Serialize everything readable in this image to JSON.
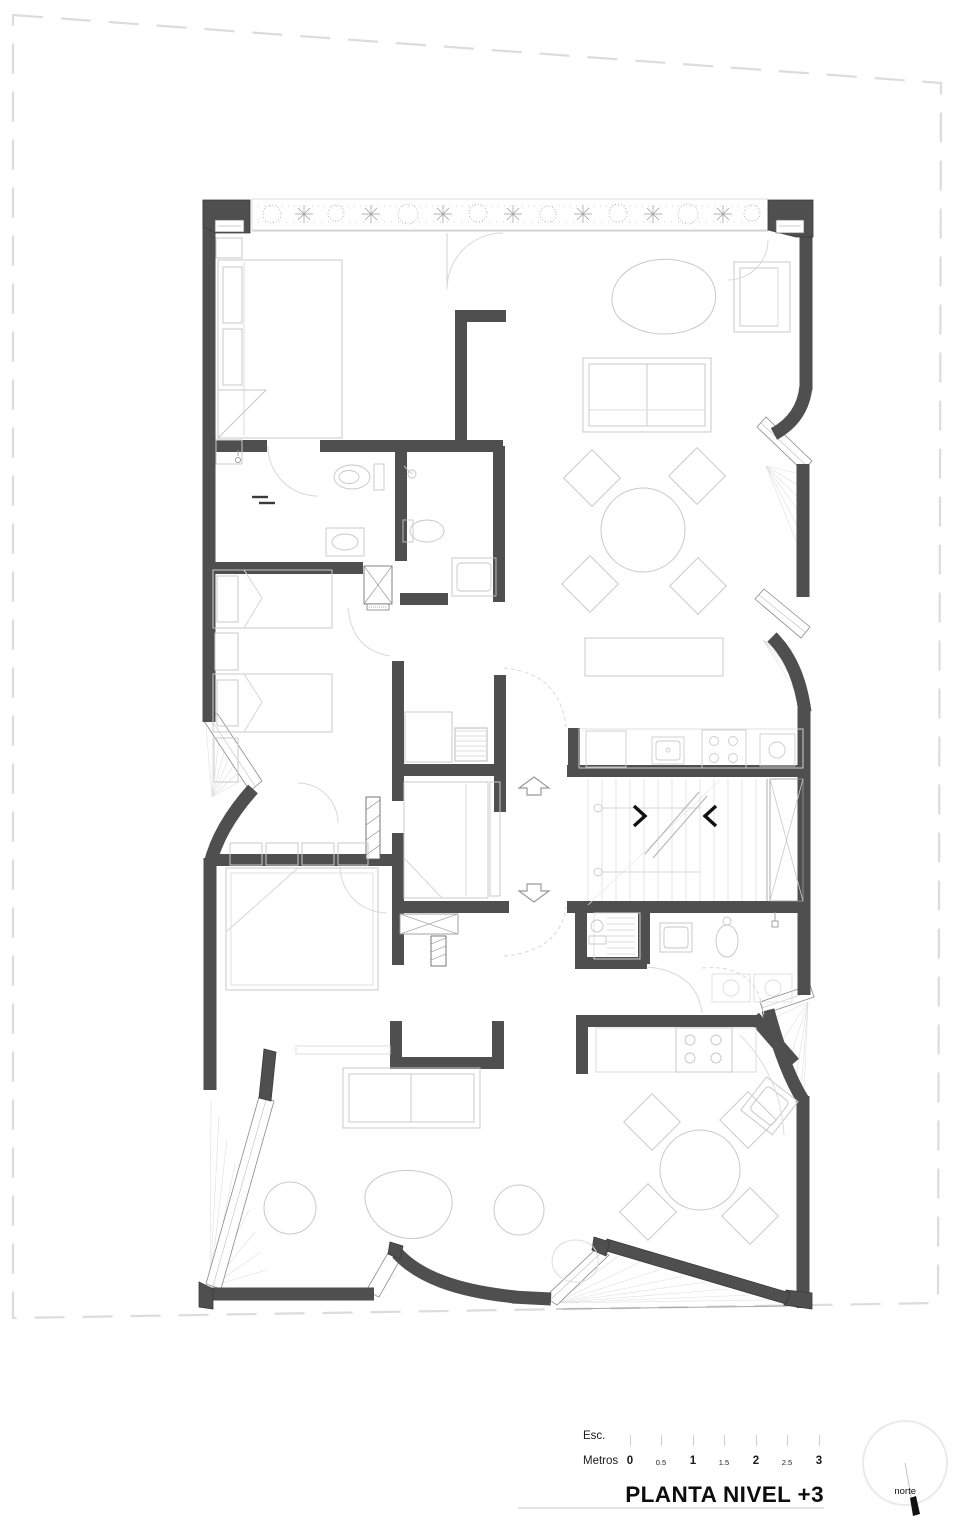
{
  "title_block": {
    "scale_label": "Esc.",
    "units_label": "Metros",
    "ticks": [
      "0",
      "0.5",
      "1",
      "1.5",
      "2",
      "2.5",
      "3"
    ],
    "title": "PLANTA NIVEL +3",
    "north_label": "norte"
  },
  "colors": {
    "wall": "#4f4f4f",
    "furniture_line": "#c9c9c9",
    "fan_hatch": "#dfdfdf",
    "property_line": "#dcdcdc",
    "text": "#111111"
  }
}
